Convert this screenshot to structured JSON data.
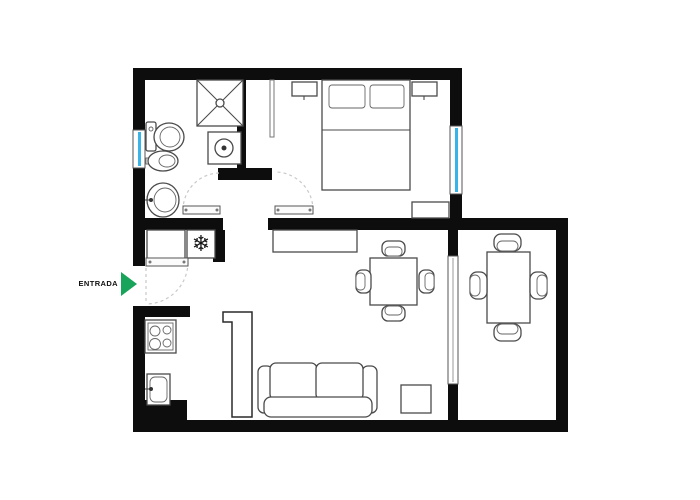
{
  "labels": {
    "entrance": "ENTRADA"
  },
  "icons": {
    "snowflake": "❄"
  },
  "colors": {
    "wall": "#0d0d0d",
    "window": "#38b4e9",
    "arrow": "#18a45a",
    "stroke": "#4a4a4a",
    "arc": "#c9c9c9",
    "bg": "#ffffff"
  }
}
